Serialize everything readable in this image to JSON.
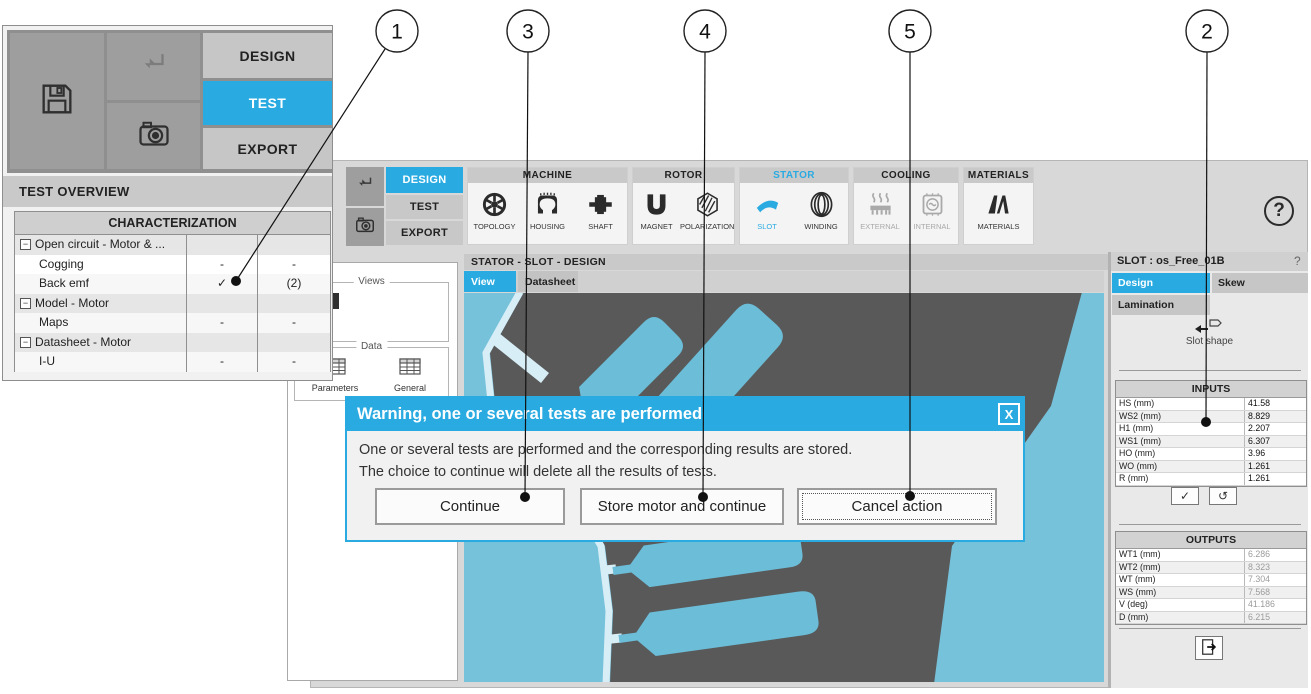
{
  "colors": {
    "accent": "#29abe2",
    "stator_gray": "#595959",
    "view_background": "#76c2db",
    "slot_blue": "#6cbdd8",
    "airgap_light": "#d8eef7"
  },
  "callouts": {
    "items": [
      {
        "label": "1"
      },
      {
        "label": "3"
      },
      {
        "label": "4"
      },
      {
        "label": "5"
      },
      {
        "label": "2"
      }
    ]
  },
  "inset": {
    "toolbar": {
      "design": "DESIGN",
      "test": "TEST",
      "export": "EXPORT"
    },
    "overview_title": "TEST OVERVIEW",
    "table": {
      "header": "CHARACTERIZATION",
      "rows": [
        {
          "label": "Open circuit - Motor & ...",
          "group": true,
          "c1": "",
          "c2": ""
        },
        {
          "label": "Cogging",
          "group": false,
          "c1": "-",
          "c2": "-"
        },
        {
          "label": "Back emf",
          "group": false,
          "c1": "✓",
          "c2": "(2)"
        },
        {
          "label": "Model - Motor",
          "group": true,
          "c1": "",
          "c2": ""
        },
        {
          "label": "Maps",
          "group": false,
          "c1": "-",
          "c2": "-"
        },
        {
          "label": "Datasheet - Motor",
          "group": true,
          "c1": "",
          "c2": ""
        },
        {
          "label": "I-U",
          "group": false,
          "c1": "-",
          "c2": "-"
        }
      ]
    }
  },
  "app": {
    "nav": {
      "design": "DESIGN",
      "test": "TEST",
      "export": "EXPORT"
    },
    "ribbon": {
      "groups": [
        {
          "name": "MACHINE",
          "items": [
            {
              "label": "TOPOLOGY",
              "icon": "topology-icon"
            },
            {
              "label": "HOUSING",
              "icon": "housing-icon"
            },
            {
              "label": "SHAFT",
              "icon": "shaft-icon"
            }
          ]
        },
        {
          "name": "ROTOR",
          "items": [
            {
              "label": "MAGNET",
              "icon": "magnet-icon"
            },
            {
              "label": "POLARIZATION",
              "icon": "polarization-icon"
            }
          ]
        },
        {
          "name": "STATOR",
          "accent": true,
          "items": [
            {
              "label": "SLOT",
              "icon": "slot-icon",
              "active": true
            },
            {
              "label": "WINDING",
              "icon": "winding-icon"
            }
          ]
        },
        {
          "name": "COOLING",
          "items": [
            {
              "label": "EXTERNAL",
              "icon": "external-icon",
              "disabled": true
            },
            {
              "label": "INTERNAL",
              "icon": "internal-icon",
              "disabled": true
            }
          ]
        },
        {
          "name": "MATERIALS",
          "items": [
            {
              "label": "MATERIALS",
              "icon": "materials-icon"
            }
          ]
        }
      ]
    },
    "help": "?",
    "content": {
      "header": "STATOR - SLOT - DESIGN",
      "tabs": [
        {
          "label": "View",
          "active": true
        },
        {
          "label": "Datasheet",
          "active": false
        }
      ]
    },
    "sidebar": {
      "views_label": "Views",
      "data_label": "Data",
      "items": [
        {
          "label": "Parameters",
          "icon": "parameters-icon"
        },
        {
          "label": "General",
          "icon": "general-icon"
        }
      ]
    },
    "slot_panel": {
      "title": "SLOT : os_Free_01B",
      "help": "?",
      "tabs": [
        {
          "label": "Design",
          "active": true
        },
        {
          "label": "Skew",
          "active": false
        },
        {
          "label": "Lamination",
          "active": false
        }
      ],
      "slot_shape_label": "Slot shape",
      "inputs": {
        "title": "INPUTS",
        "rows": [
          [
            "HS (mm)",
            "41.58"
          ],
          [
            "WS2 (mm)",
            "8.829"
          ],
          [
            "H1 (mm)",
            "2.207"
          ],
          [
            "WS1 (mm)",
            "6.307"
          ],
          [
            "HO (mm)",
            "3.96"
          ],
          [
            "WO (mm)",
            "1.261"
          ],
          [
            "R (mm)",
            "1.261"
          ]
        ]
      },
      "outputs": {
        "title": "OUTPUTS",
        "rows": [
          [
            "WT1 (mm)",
            "6.286"
          ],
          [
            "WT2 (mm)",
            "8.323"
          ],
          [
            "WT (mm)",
            "7.304"
          ],
          [
            "WS (mm)",
            "7.568"
          ],
          [
            "V (deg)",
            "41.186"
          ],
          [
            "D (mm)",
            "6.215"
          ]
        ]
      }
    }
  },
  "dialog": {
    "title": "Warning, one or several tests are performed",
    "close": "X",
    "lines": [
      "One or several tests are performed and the corresponding results are stored.",
      "The choice to continue will delete all the results of tests."
    ],
    "buttons": [
      "Continue",
      "Store motor and continue",
      "Cancel action"
    ]
  }
}
